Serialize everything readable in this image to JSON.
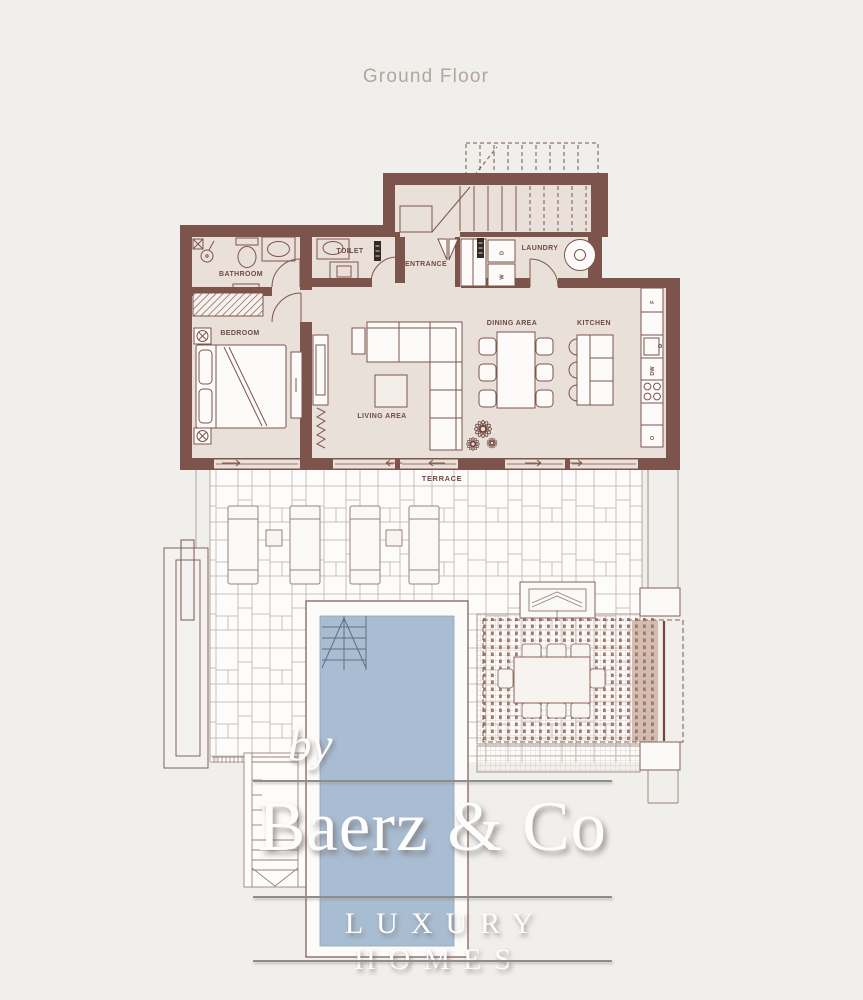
{
  "title": "Ground Floor",
  "rooms": {
    "bathroom": "BATHROOM",
    "toilet": "TOILET",
    "entrance": "ENTRANCE",
    "laundry": "LAUNDRY",
    "bedroom": "BEDROOM",
    "living_area": "LIVING AREA",
    "dining_area": "DINING AREA",
    "kitchen": "KITCHEN",
    "terrace": "TERRACE"
  },
  "appliances": {
    "fridge": "F",
    "dishwasher": "DW",
    "oven": "O",
    "washer": "W",
    "dryer": "D"
  },
  "watermark": {
    "prefix": "by",
    "brand": "Baerz & Co",
    "tagline": "LUXURY HOMES"
  },
  "colors": {
    "background": "#f0efec",
    "wall": "#7d544c",
    "room_floor": "#eae0da",
    "furniture_fill": "#fcfbfa",
    "tile_line": "#c8c0b8",
    "pool_water": "#a9bdd2",
    "pergola_deck": "#d3bdb0",
    "louver_dot": "#a1786d",
    "title_text": "#b3a5a0",
    "watermark_text": "#fdfdfd",
    "watermark_rule": "#8d8d8b"
  }
}
